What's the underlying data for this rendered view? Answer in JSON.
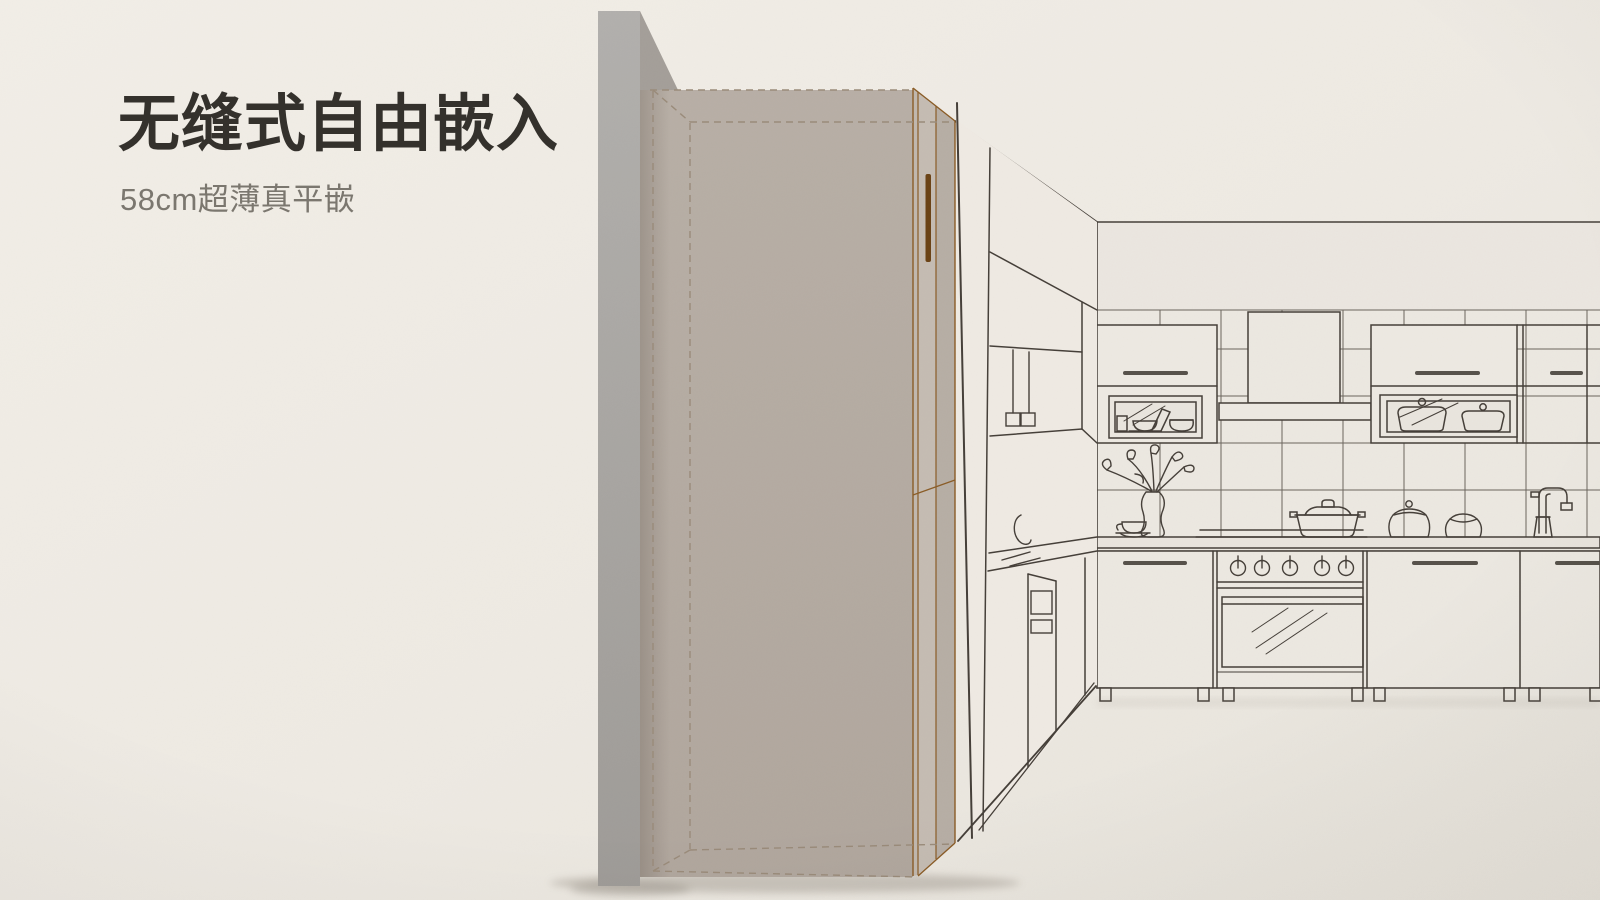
{
  "page": {
    "type": "product-feature-banner"
  },
  "headline": {
    "title": "无缝式自由嵌入",
    "subtitle": "58cm超薄真平嵌"
  },
  "colors": {
    "bg": "#efebe4",
    "title-text": "#34312c",
    "subtitle-text": "#7b776f",
    "wall-gray": "#a7a4a0",
    "panel-taupe": "#b5aca3",
    "fridge-face": "#c1b8af",
    "accent-brown": "#8a5c26",
    "handle-brown": "#6b4316",
    "line-dark": "#453f39",
    "dash-tan": "#9a8b7a"
  },
  "scene": {
    "elements": [
      "wall-cutaway",
      "embedded-fridge",
      "fridge-handle",
      "kitchen-upper-cabinets",
      "glass-display-cases",
      "range-hood",
      "backsplash-tiles",
      "countertop",
      "stove-oven",
      "flower-vase",
      "cooking-pot",
      "storage-jars",
      "faucet",
      "lower-cabinets"
    ]
  }
}
